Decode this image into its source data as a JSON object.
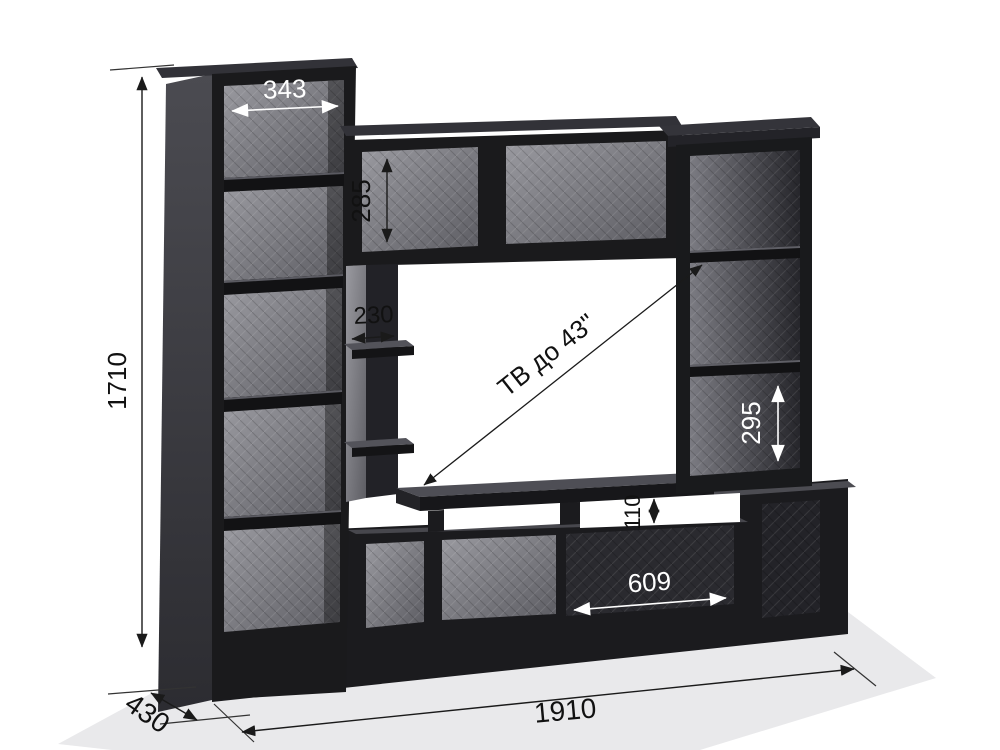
{
  "drawing": {
    "kind": "furniture-dimension-diagram",
    "labels": {
      "total_height": "1710",
      "total_width": "1910",
      "depth": "430",
      "left_column_opening_width": "343",
      "top_shelf_opening_height": "285",
      "middle_shelf_width": "230",
      "right_column_opening_height": "295",
      "tv_shelf_gap_height": "110",
      "bottom_niche_width": "609",
      "tv_capacity_note": "ТВ до 43\""
    },
    "colors": {
      "furniture_dark": "#1a1a1c",
      "panel_back_light": "#8f8f95",
      "background": "#ffffff",
      "floor_shadow": "#e9e9eb",
      "dimension_dark": "#1a1a1a",
      "dimension_light": "#ffffff"
    }
  }
}
